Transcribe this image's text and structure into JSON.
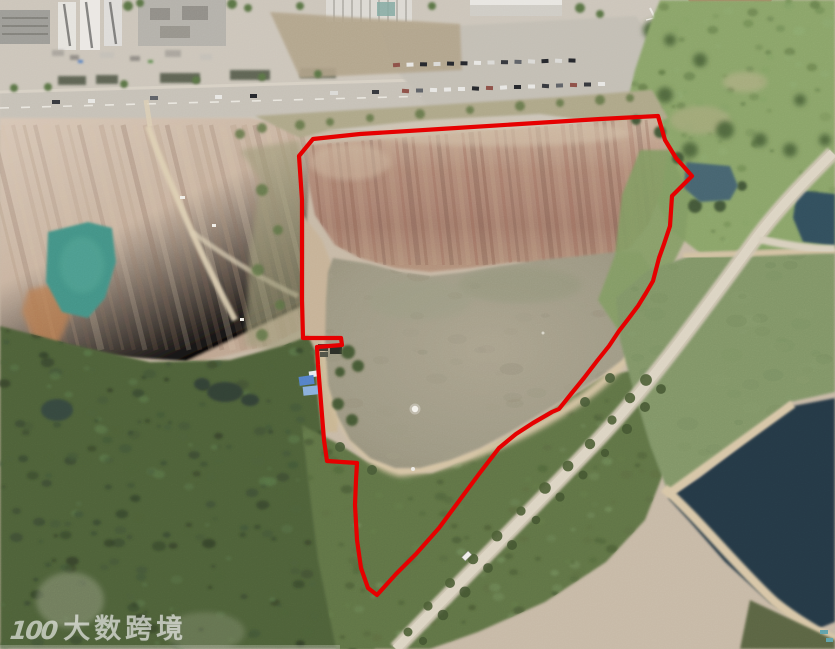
{
  "meta": {
    "description": "Aerial drone photograph of a reclaimed quarry land parcel outlined with a red site-boundary annotation; urban road and buildings at top, turquoise quarry pond at left, large muddy retention pond in the center, forest at bottom left, dirt road and fish ponds at right, watermark at bottom left."
  },
  "annotation": {
    "boundary_color": "#e60000",
    "boundary_points": "313,139 360,134 440,129 520,124 600,119 658,116 665,140 676,158 692,176 681,187 672,196 670,226 664,244 659,258 653,281 646,293 638,306 629,318 619,331 609,346 597,361 584,378 571,394 559,409 552,412 533,423 516,434 499,448 479,474 459,501 439,528 416,554 396,574 377,595 368,588 361,568 357,540 355,505 356,480 357,463 327,461 324,440 322,415 320,390 318,365 317,347 342,345 341,338 303,338 302,300 302,250 302,200 299,156"
  },
  "watermark": {
    "logo_text": "100",
    "brand_text": "大数跨境",
    "color": "#ffffff"
  },
  "scene": {
    "features": [
      "urban-road-with-buildings-top",
      "parking-lot-with-cars",
      "sports-field-red-track-top-right",
      "quarry-with-turquoise-pond-left",
      "excavated-red-brown-slope",
      "muddy-retention-pond-center",
      "blue-tarp-shack",
      "dense-forest-bottom-left",
      "diagonal-dirt-road-right",
      "green-fish-pond",
      "dark-fish-pond",
      "red-site-boundary-outline",
      "brand-watermark"
    ],
    "colors": {
      "quarry_pond": "#3c9184",
      "retention_pond": "#a29c86",
      "green_fish_pond": "#7d9364",
      "dark_fish_pond": "#1f3240",
      "slope_earth": "#a97f6d",
      "quarry_earth": "#cdb9a6",
      "forest": "#425631",
      "road_paved": "#c6c1b7",
      "road_dirt": "#d9d1c0",
      "sports_track": "#c2625e"
    }
  }
}
